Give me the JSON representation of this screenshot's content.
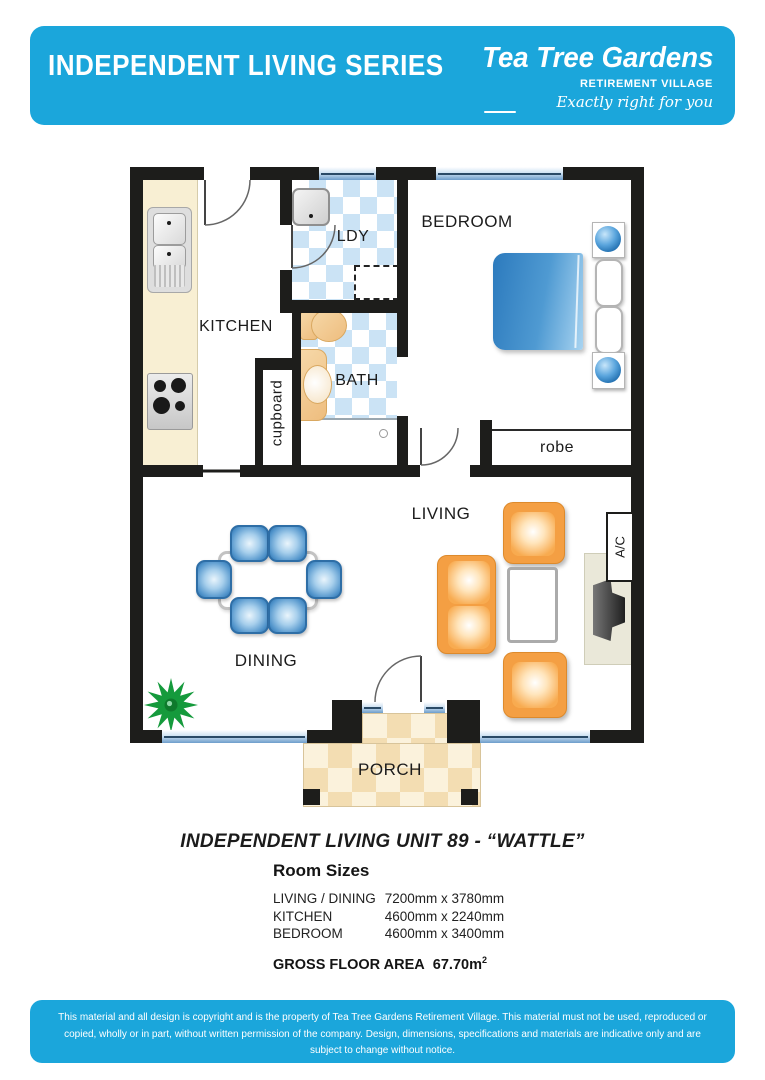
{
  "header": {
    "title": "INDEPENDENT LIVING SERIES",
    "logo": {
      "name": "Tea Tree Gardens",
      "subtitle": "RETIREMENT VILLAGE",
      "tagline": "Exactly right for you"
    }
  },
  "plan": {
    "labels": {
      "kitchen": "KITCHEN",
      "ldy": "LDY",
      "bath": "BATH",
      "cupboard": "cupboard",
      "bedroom": "BEDROOM",
      "robe": "robe",
      "living": "LIVING",
      "dining": "DINING",
      "porch": "PORCH",
      "ac": "A/C"
    }
  },
  "unit_title": "INDEPENDENT LIVING UNIT 89 - “WATTLE”",
  "room_sizes": {
    "heading": "Room Sizes",
    "rows": [
      {
        "name": "LIVING / DINING",
        "size": "7200mm x 3780mm"
      },
      {
        "name": "KITCHEN",
        "size": "4600mm x 2240mm"
      },
      {
        "name": "BEDROOM",
        "size": "4600mm x 3400mm"
      }
    ],
    "gross": {
      "label": "GROSS FLOOR AREA",
      "value": "67.70m",
      "superscript": "2"
    }
  },
  "footer": {
    "disclaimer": "This material and all design is copyright and is the property of Tea Tree Gardens Retirement Village. This material must not be used, reproduced or copied, wholly or in part, without written permission of the company. Design, dimensions, specifications and materials are indicative only and are subject to change without notice."
  },
  "colors": {
    "brand_blue": "#1BA6DB",
    "wall": "#1D1D1B",
    "counter_cream": "#F8EFD3",
    "tile_blue": "#CBE3F5",
    "porch_tan": "#F3DDB2",
    "furniture_orange": "#F49F43",
    "furniture_blue": "#4E92CA",
    "bed_blue": "#2C7ABD",
    "fixture_tan": "#EEBD7E",
    "plant_green": "#159A3C"
  }
}
